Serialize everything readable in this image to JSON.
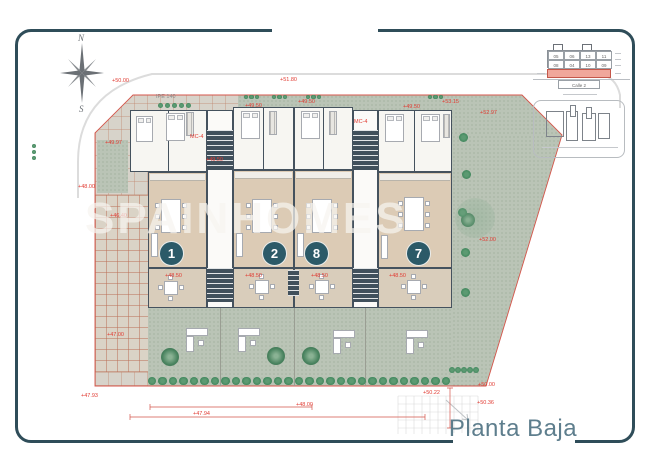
{
  "title": "Planta Baja",
  "watermark_text": "SPAINHOMES",
  "compass": {
    "north": "N",
    "south": "S"
  },
  "frame_color": "#2f4d59",
  "accent_red": "#e13b32",
  "unit_circle_color": "#2c5a68",
  "units": [
    {
      "number": "1",
      "x": 159,
      "y": 241
    },
    {
      "number": "2",
      "x": 262,
      "y": 241
    },
    {
      "number": "8",
      "x": 304,
      "y": 241
    },
    {
      "number": "7",
      "x": 406,
      "y": 241
    }
  ],
  "key_plan": {
    "row1": [
      "05",
      "06",
      "13",
      "11"
    ],
    "row2": [
      "08",
      "04",
      "10",
      "09"
    ],
    "street_label": "Calle 2",
    "highlight_color": "#f0a79b"
  },
  "labels": [
    {
      "t": "+50.00",
      "x": 112,
      "y": 78
    },
    {
      "t": "+51.80",
      "x": 280,
      "y": 77
    },
    {
      "t": "+53.15",
      "x": 442,
      "y": 99
    },
    {
      "t": "+52.97",
      "x": 480,
      "y": 110
    },
    {
      "t": "+49.50",
      "x": 245,
      "y": 103
    },
    {
      "t": "+49.50",
      "x": 298,
      "y": 99
    },
    {
      "t": "+49.50",
      "x": 403,
      "y": 104
    },
    {
      "t": "+49.97",
      "x": 105,
      "y": 140
    },
    {
      "t": "+48.00",
      "x": 78,
      "y": 184
    },
    {
      "t": "+46.40",
      "x": 110,
      "y": 213
    },
    {
      "t": "+49.50",
      "x": 206,
      "y": 157
    },
    {
      "t": "MC-4",
      "x": 190,
      "y": 134
    },
    {
      "t": "MC-4",
      "x": 354,
      "y": 119
    },
    {
      "t": "IPE 140",
      "x": 156,
      "y": 94,
      "gray": true
    },
    {
      "t": "+48.50",
      "x": 165,
      "y": 273
    },
    {
      "t": "+48.50",
      "x": 245,
      "y": 273
    },
    {
      "t": "+48.50",
      "x": 311,
      "y": 273
    },
    {
      "t": "+48.50",
      "x": 389,
      "y": 273
    },
    {
      "t": "+47.00",
      "x": 107,
      "y": 332
    },
    {
      "t": "+52.00",
      "x": 479,
      "y": 237
    },
    {
      "t": "+47.93",
      "x": 81,
      "y": 393
    },
    {
      "t": "+47.94",
      "x": 193,
      "y": 411
    },
    {
      "t": "+48.00",
      "x": 296,
      "y": 402
    },
    {
      "t": "+50.22",
      "x": 423,
      "y": 390
    },
    {
      "t": "+50.00",
      "x": 478,
      "y": 382
    },
    {
      "t": "+50.36",
      "x": 477,
      "y": 400
    }
  ]
}
